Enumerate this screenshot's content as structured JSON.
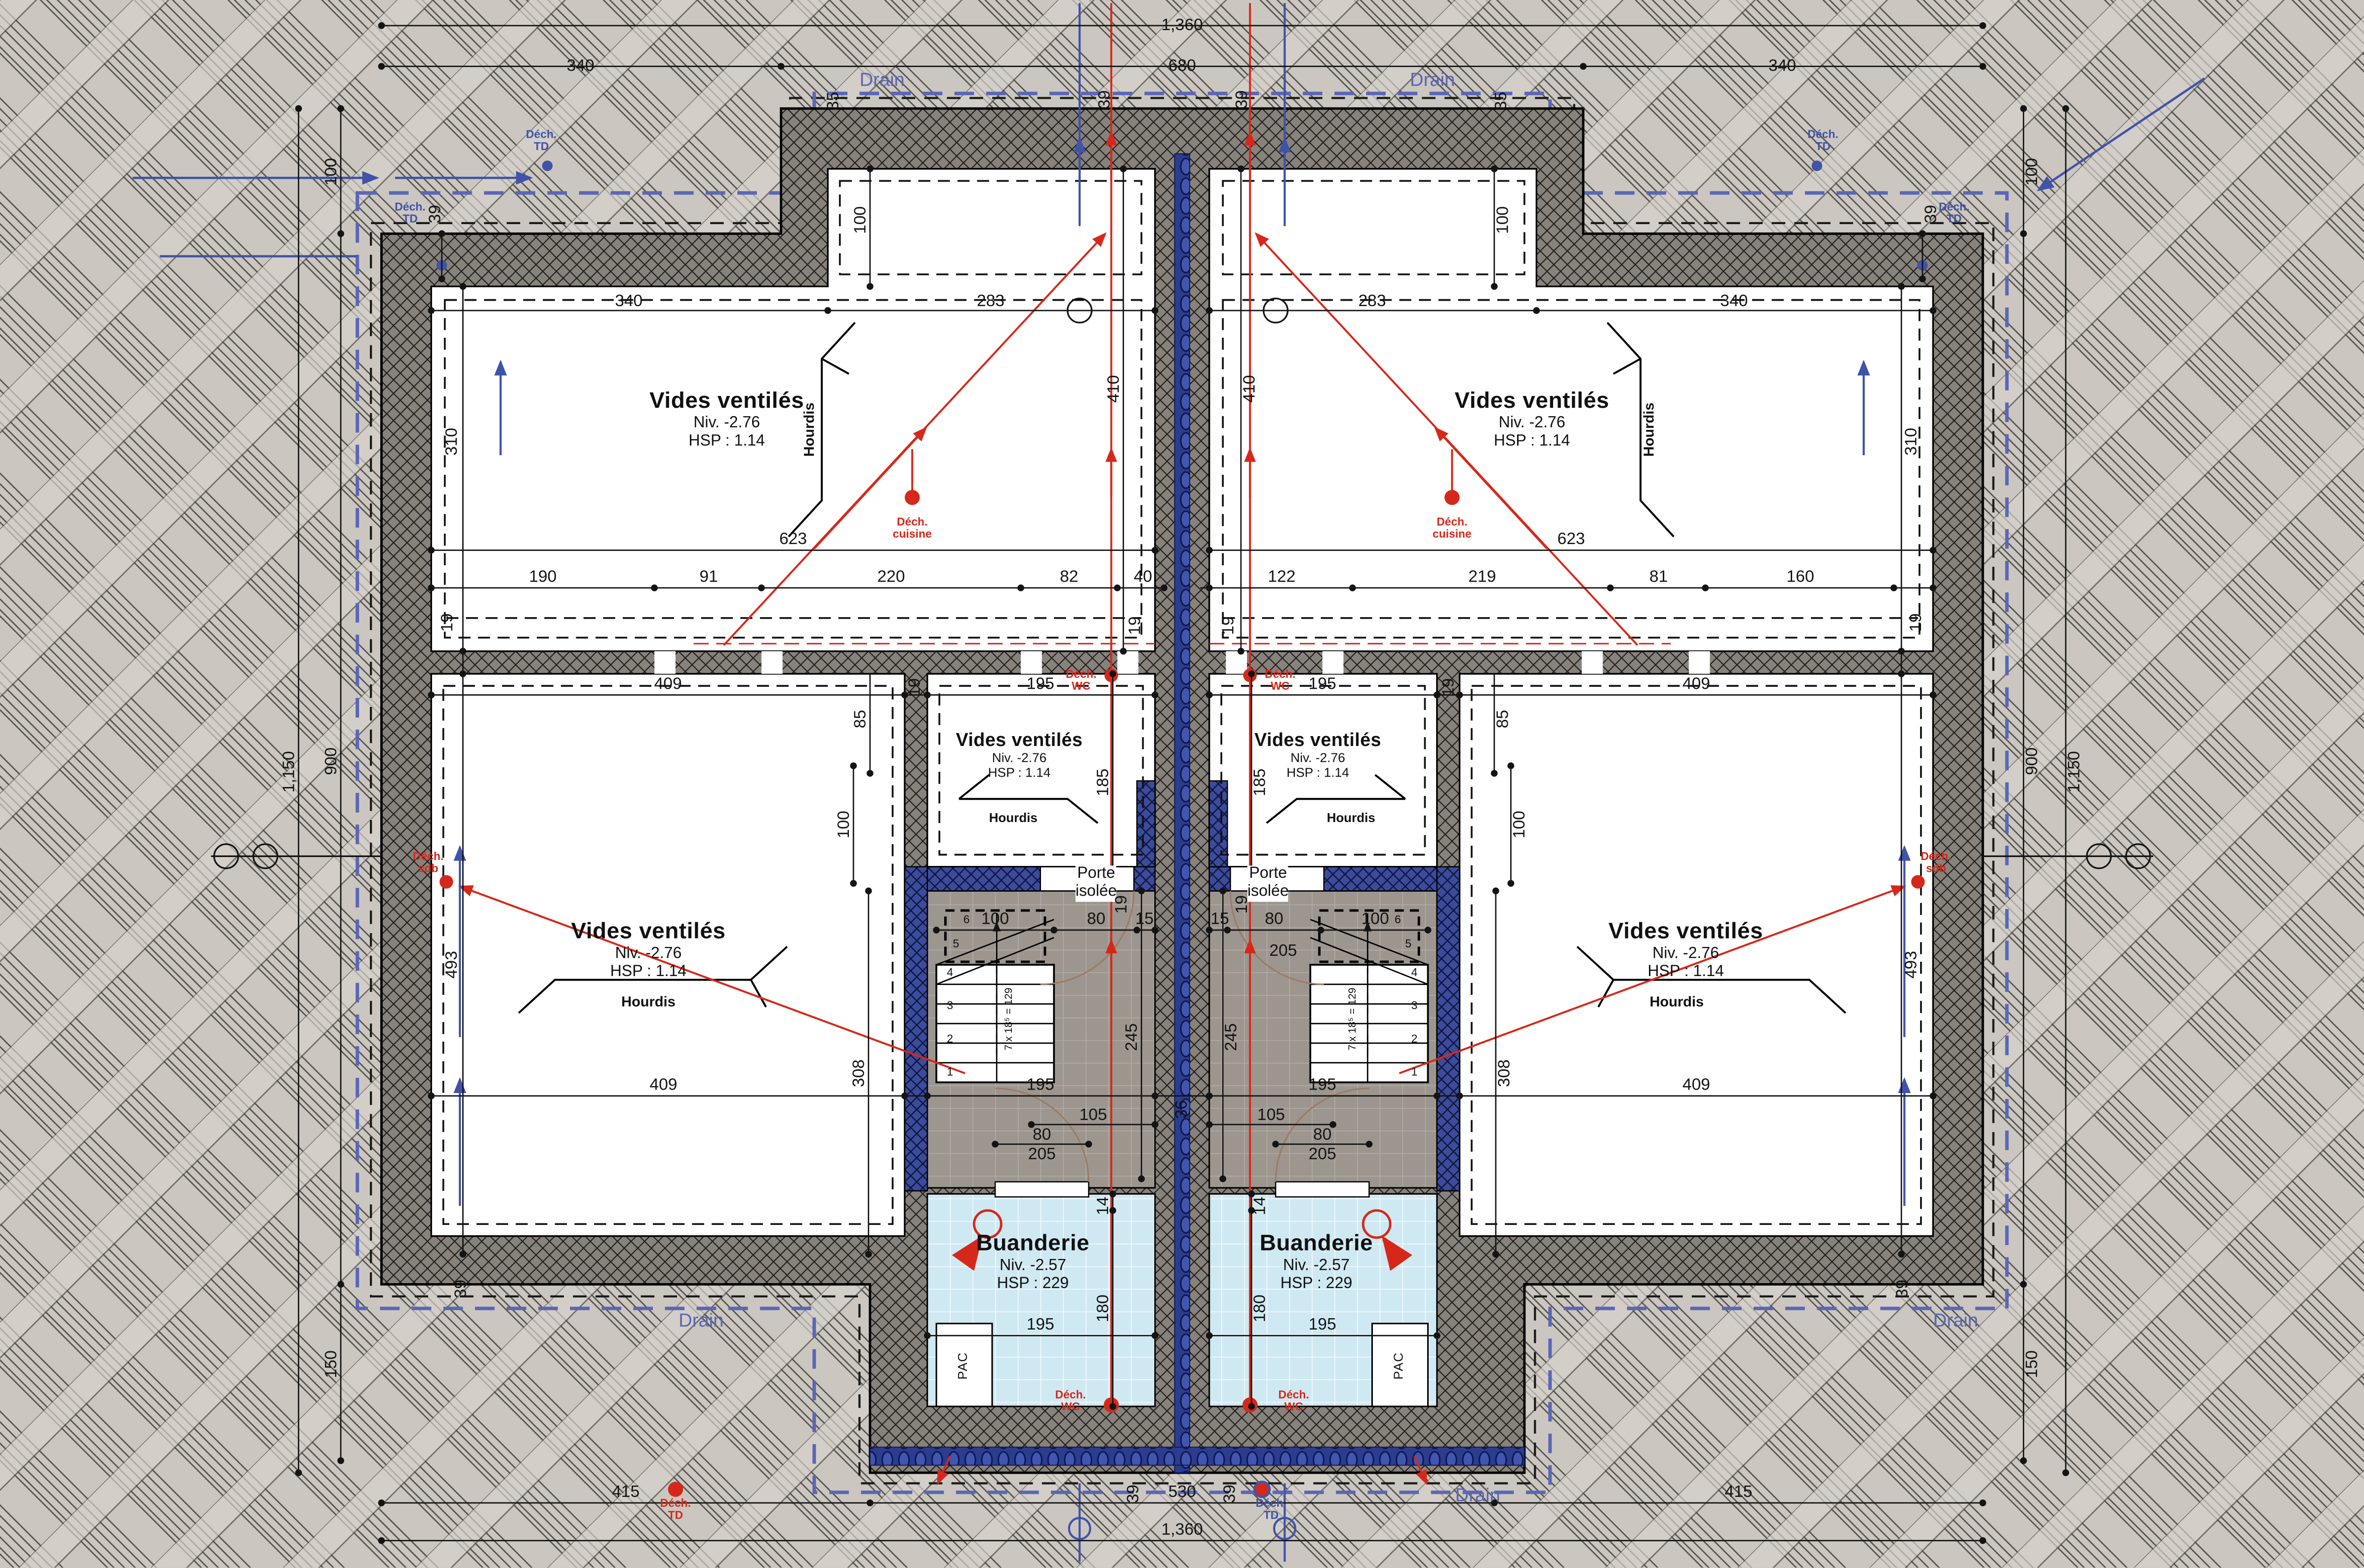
{
  "rooms": {
    "vv": {
      "title": "Vides ventilés",
      "niv": "Niv. -2.76",
      "hsp": "HSP : 1.14"
    },
    "buanderie": {
      "title": "Buanderie",
      "niv": "Niv. -2.57",
      "hsp": "HSP : 229"
    }
  },
  "annotations": {
    "hourdis": "Hourdis",
    "porte": "Porte\nisolée",
    "pac": "PAC",
    "drain": "Drain",
    "dech_cuisine": "Déch.\ncuisine",
    "dech_wc": "Déch.\nWC",
    "dech_sdb": "Déch.\nsdb",
    "dech_td": "Déch.\nTD",
    "stair_note": "7 x 18⁵ = 129",
    "steps": [
      "1",
      "2",
      "3",
      "4",
      "5",
      "6"
    ]
  },
  "colors": {
    "red": "#d6281a",
    "blue": "#4053a8",
    "drain_blue": "#5a67b5",
    "wall_navy": "#3c4c9a",
    "buanderie_fill": "#cfe9f3",
    "terrain": "#ccc8c1"
  },
  "dims": [
    "1,360",
    "340",
    "680",
    "340",
    "35",
    "39",
    "39",
    "35",
    "100",
    "39",
    "100",
    "100",
    "39",
    "100",
    "340",
    "283",
    "283",
    "340",
    "310",
    "410",
    "410",
    "310",
    "623",
    "623",
    "190",
    "91",
    "220",
    "82",
    "40",
    "122",
    "219",
    "81",
    "160",
    "19",
    "19",
    "19",
    "19",
    "409",
    "19",
    "195",
    "195",
    "19",
    "409",
    "85",
    "85",
    "100",
    "100",
    "185",
    "185",
    "100",
    "80",
    "15",
    "15",
    "80",
    "205",
    "100",
    "19",
    "19",
    "245",
    "245",
    "308",
    "308",
    "493",
    "493",
    "409",
    "195",
    "36",
    "195",
    "409",
    "105",
    "105",
    "80",
    "205",
    "80",
    "205",
    "14",
    "14",
    "180",
    "180",
    "195",
    "195",
    "39",
    "39",
    "150",
    "150",
    "900",
    "1,150",
    "900",
    "1,150",
    "39",
    "39",
    "415",
    "530",
    "415",
    "1,360"
  ]
}
